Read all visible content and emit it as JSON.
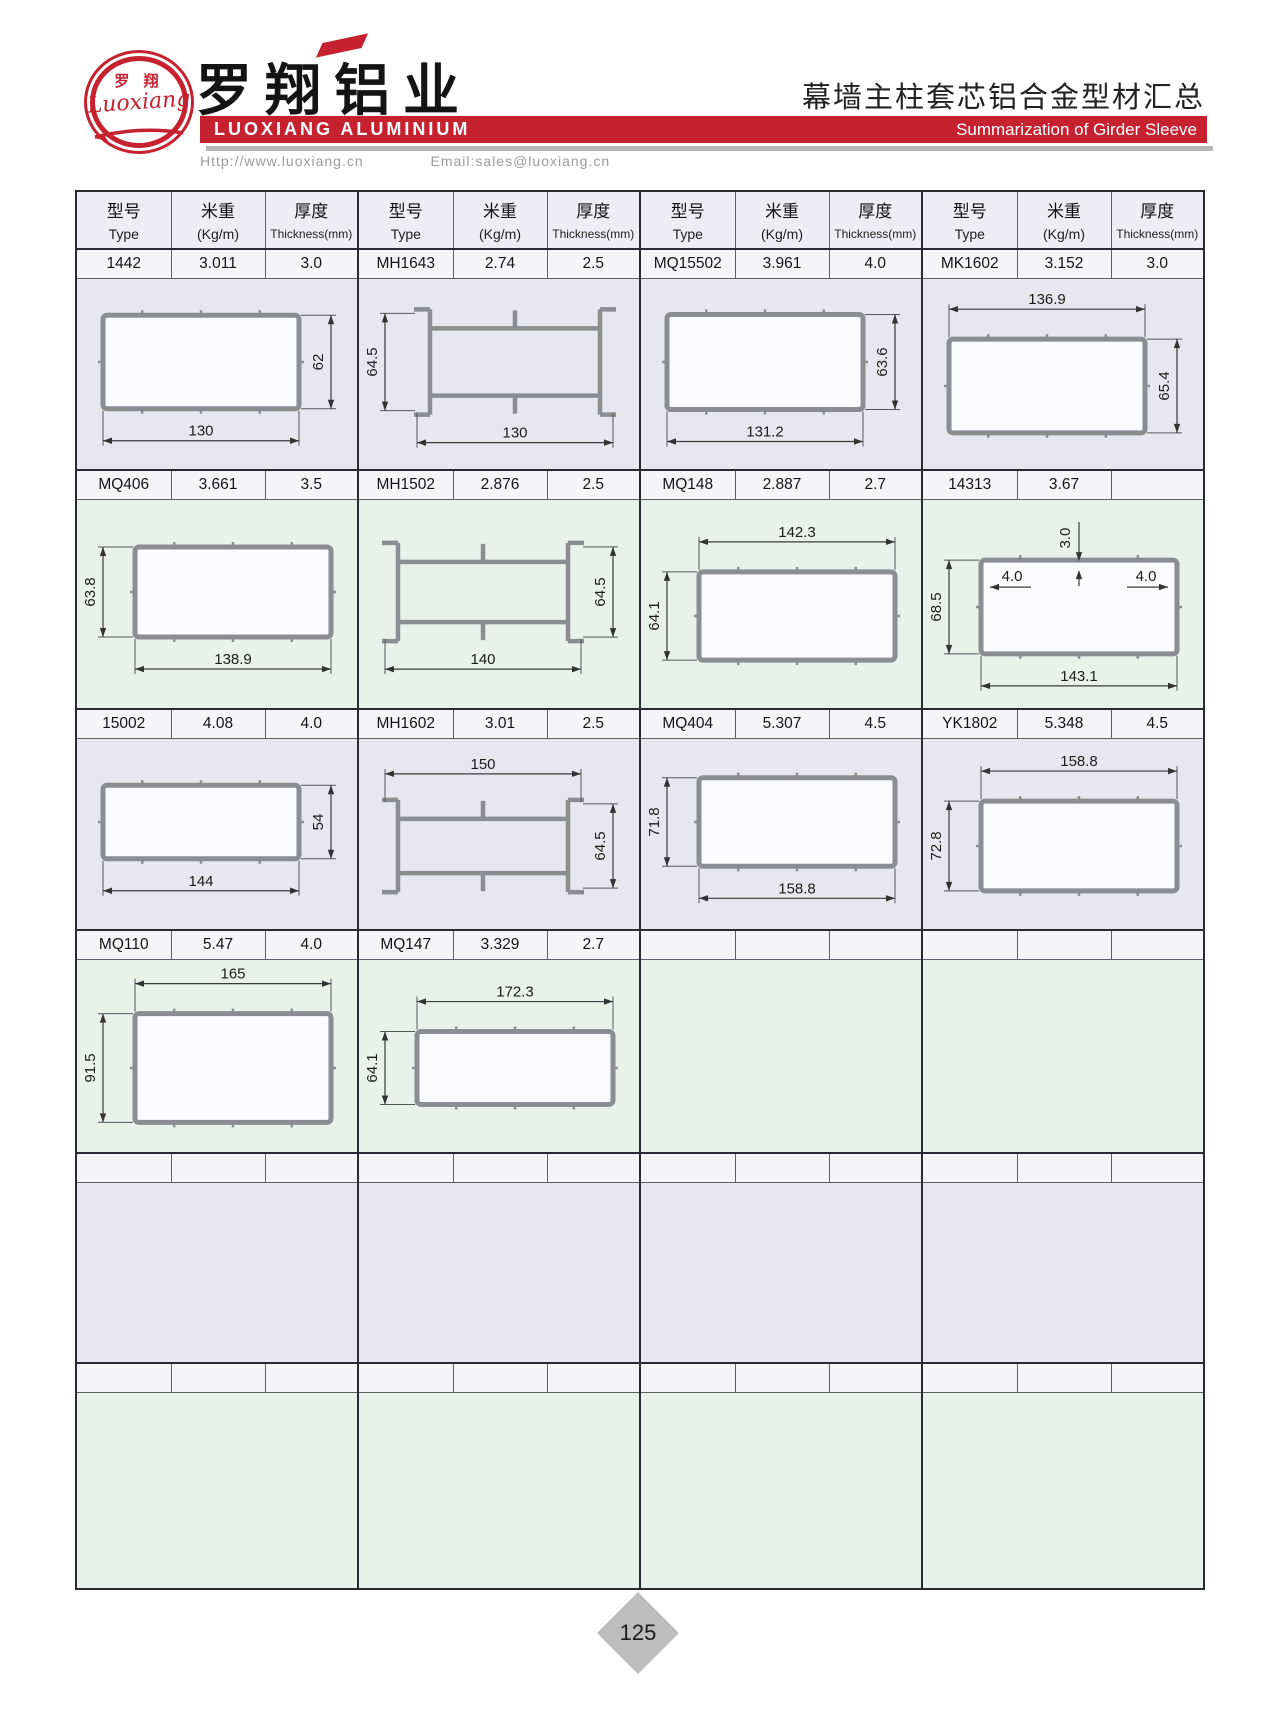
{
  "header": {
    "logo_cn": "罗 翔",
    "logo_script": "Luoxiang",
    "company_cn": "罗翔铝业",
    "company_en": "LUOXIANG ALUMINIUM",
    "website": "Http://www.luoxiang.cn",
    "email": "Email:sales@luoxiang.cn",
    "title_cn": "幕墙主柱套芯铝合金型材汇总",
    "title_en": "Summarization of Girder Sleeve"
  },
  "colors": {
    "accent_red": "#c5212f",
    "band_lavender": "#e8e6f1",
    "band_green": "#e9f1ea",
    "header_row_bg": "#eeedf3",
    "profile_stroke": "#8b8d92"
  },
  "table": {
    "col_headers": [
      {
        "cn": "型号",
        "en": "Type"
      },
      {
        "cn": "米重",
        "en": "(Kg/m)"
      },
      {
        "cn": "厚度",
        "en": "Thickness(mm)"
      }
    ],
    "rows": [
      {
        "cells": [
          {
            "type": "1442",
            "weight": "3.011",
            "thickness": "3.0",
            "profile": "tube",
            "dim_bottom": "130",
            "dim_right": "62"
          },
          {
            "type": "MH1643",
            "weight": "2.74",
            "thickness": "2.5",
            "profile": "hbeam",
            "dim_left": "64.5",
            "dim_bottom": "130"
          },
          {
            "type": "MQ15502",
            "weight": "3.961",
            "thickness": "4.0",
            "profile": "tube",
            "dim_bottom": "131.2",
            "dim_right": "63.6"
          },
          {
            "type": "MK1602",
            "weight": "3.152",
            "thickness": "3.0",
            "profile": "tube",
            "dim_top": "136.9",
            "dim_right": "65.4"
          }
        ]
      },
      {
        "cells": [
          {
            "type": "MQ406",
            "weight": "3.661",
            "thickness": "3.5",
            "profile": "tube",
            "dim_left": "63.8",
            "dim_bottom": "138.9"
          },
          {
            "type": "MH1502",
            "weight": "2.876",
            "thickness": "2.5",
            "profile": "hbeam",
            "dim_right": "64.5",
            "dim_bottom": "140"
          },
          {
            "type": "MQ148",
            "weight": "2.887",
            "thickness": "2.7",
            "profile": "tube",
            "dim_top": "142.3",
            "dim_left": "64.1"
          },
          {
            "type": "14313",
            "weight": "3.67",
            "thickness": "",
            "profile": "tube",
            "dim_left": "68.5",
            "dim_bottom": "143.1",
            "extra_dims": [
              {
                "label": "3.0",
                "pos": "top-center-vertical"
              },
              {
                "label": "4.0",
                "pos": "inner-top-left"
              },
              {
                "label": "4.0",
                "pos": "inner-top-right"
              }
            ]
          }
        ]
      },
      {
        "cells": [
          {
            "type": "15002",
            "weight": "4.08",
            "thickness": "4.0",
            "profile": "tube",
            "dim_right": "54",
            "dim_bottom": "144"
          },
          {
            "type": "MH1602",
            "weight": "3.01",
            "thickness": "2.5",
            "profile": "hbeam",
            "dim_top": "150",
            "dim_right": "64.5"
          },
          {
            "type": "MQ404",
            "weight": "5.307",
            "thickness": "4.5",
            "profile": "tube",
            "dim_left": "71.8",
            "dim_bottom": "158.8"
          },
          {
            "type": "YK1802",
            "weight": "5.348",
            "thickness": "4.5",
            "profile": "tube",
            "dim_top": "158.8",
            "dim_left": "72.8"
          }
        ]
      },
      {
        "cells": [
          {
            "type": "MQ110",
            "weight": "5.47",
            "thickness": "4.0",
            "profile": "tube",
            "dim_top": "165",
            "dim_left": "91.5"
          },
          {
            "type": "MQ147",
            "weight": "3.329",
            "thickness": "2.7",
            "profile": "tube",
            "dim_top": "172.3",
            "dim_left": "64.1"
          },
          {},
          {}
        ]
      },
      {
        "cells": [
          {},
          {},
          {},
          {}
        ]
      },
      {
        "cells": [
          {},
          {},
          {},
          {}
        ]
      }
    ]
  },
  "footer": {
    "page_number": "125"
  }
}
